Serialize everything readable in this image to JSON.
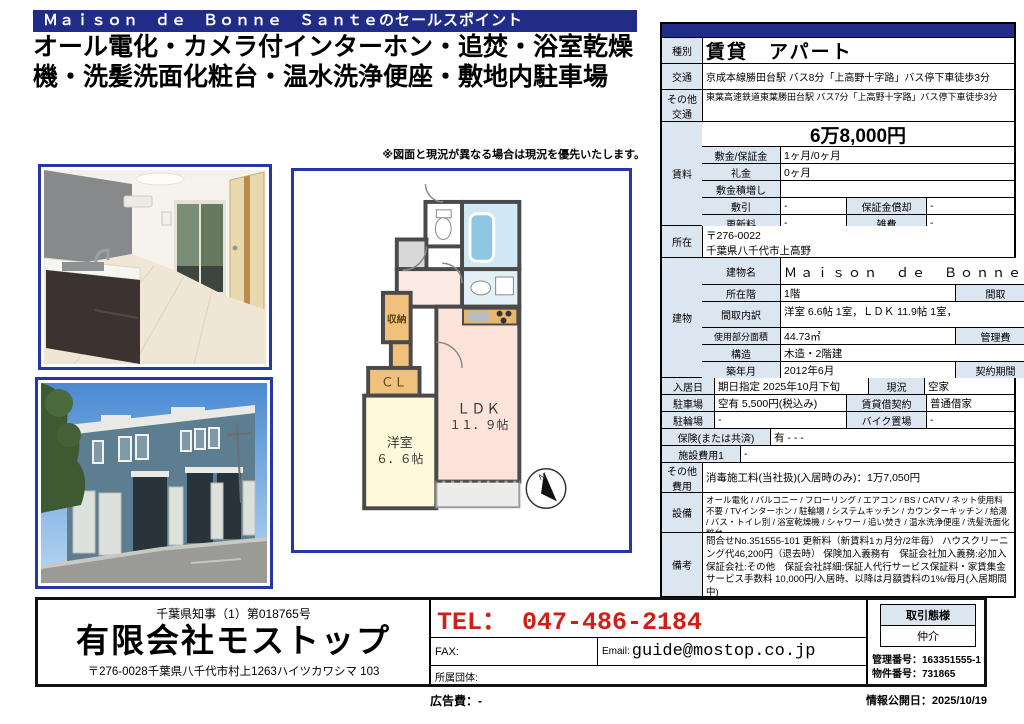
{
  "header": {
    "title_bar": "Ｍａｉｓｏｎ　ｄｅ　Ｂｏｎｎｅ　Ｓａｎｔｅのセールスポイント",
    "sales_points": "オール電化・カメラ付インターホン・追焚・浴室乾燥機・洗髪洗面化粧台・温水洗浄便座・敷地内駐車場"
  },
  "note": "※図面と現況が異なる場合は現況を優先いたします。",
  "floorplan": {
    "closet": "収納",
    "cl": "ＣＬ",
    "ldk_name": "ＬＤＫ",
    "ldk_size": "１１．９帖",
    "room_name": "洋室",
    "room_size": "６．６帖",
    "compass_n": "N"
  },
  "table": {
    "type": {
      "label": "種別",
      "value": "賃貸　アパート"
    },
    "access": {
      "label": "交通",
      "value": "京成本線勝田台駅 バス8分「上高野十字路」バス停下車徒歩3分"
    },
    "other_access": {
      "label": "その他 交通",
      "value": "東葉高速鉄道東葉勝田台駅 バス7分「上高野十字路」バス停下車徒歩3分"
    },
    "rent": {
      "label": "賃料",
      "price": "6万8,000円",
      "deposit": {
        "label": "敷金/保証金",
        "value": "1ヶ月/0ヶ月"
      },
      "key_money": {
        "label": "礼金",
        "value": "0ヶ月"
      },
      "deposit_increase": {
        "label": "敷金積増し",
        "value": ""
      },
      "shikibiki": {
        "label": "敷引",
        "value": "-"
      },
      "guarantee_amort": {
        "label": "保証金償却",
        "value": "-"
      },
      "renewal_fee": {
        "label": "更新料",
        "value": "-"
      },
      "misc_fee": {
        "label": "雑費",
        "value": "-"
      }
    },
    "location": {
      "label": "所在",
      "postal": "〒276-0022",
      "address": "千葉県八千代市上高野"
    },
    "building": {
      "label": "建物",
      "name": {
        "label": "建物名",
        "value": "Ｍａｉｓｏｎ　ｄｅ　Ｂｏｎｎｅ　Ｓａｎｔｅ"
      },
      "floor": {
        "label": "所在階",
        "value": "1階"
      },
      "madori": {
        "label": "間取",
        "value": "１ＬＤＫ"
      },
      "madori_detail": {
        "label": "間取内訳",
        "value": "洋室 6.6帖 1室，ＬＤＫ 11.9帖 1室，"
      },
      "area": {
        "label": "使用部分面積",
        "value": "44.73㎡"
      },
      "mgmt_fee": {
        "label": "管理費",
        "value": "3,000円"
      },
      "structure": {
        "label": "構造",
        "value": "木造・2階建"
      },
      "built": {
        "label": "築年月",
        "value": "2012年6月"
      },
      "contract_term": {
        "label": "契約期間",
        "value": "2年"
      }
    },
    "move_in": {
      "label": "入居日",
      "value": "期日指定 2025年10月下旬"
    },
    "current": {
      "label": "現況",
      "value": "空家"
    },
    "parking": {
      "label": "駐車場",
      "value": "空有 5,500円(税込み)"
    },
    "lease_type": {
      "label": "賃貸借契約",
      "value": "普通借家"
    },
    "bicycle": {
      "label": "駐輪場",
      "value": "-"
    },
    "bike": {
      "label": "バイク置場",
      "value": "-"
    },
    "insurance": {
      "label": "保険(または共済)",
      "value": "有 - - -"
    },
    "facility_cost": {
      "label": "施設費用1",
      "value": "-"
    },
    "other_cost": {
      "label": "その他 費用",
      "value": "消毒施工料(当社扱)(入居時のみ)：1万7,050円"
    },
    "equipment": {
      "label": "設備",
      "value": "オール電化 / バルコニー / フローリング / エアコン / BS / CATV / ネット使用料不要 / TVインターホン / 駐輪場 / システムキッチン / カウンターキッチン / 給湯 / バス・トイレ別 / 浴室乾燥機 / シャワー / 追い焚き / 温水洗浄便座 / 洗髪洗面化粧台"
    },
    "remarks": {
      "label": "備考",
      "value": "問合せNo.351555-101 更新料（新賃料1ヵ月分/2年毎） ハウスクリーニング代46,200円（退去時） 保険加入義務有　保証会社加入義務:必加入　保証会社:その他　保証会社詳細:保証人代行サービス保証料・家賃集金サービス手数料 10,000円/入居時、以降は月額賃料の1%/毎月(入居期間中)"
    }
  },
  "footer": {
    "license": "千葉県知事（1）第018765号",
    "company": "有限会社モストップ",
    "address": "〒276-0028千葉県八千代市村上1263ハイツカワシマ 103",
    "tel": "TEL： 047-486-2184",
    "fax_label": "FAX:",
    "email_label": "Email:",
    "email": "guide@mostop.co.jp",
    "org_label": "所属団体:",
    "deal_type_header": "取引態様",
    "deal_type": "仲介",
    "mgmt_no": "管理番号：163351555-1",
    "property_no": "物件番号：731865",
    "ad_fee": "広告費：-",
    "published": "情報公開日：2025/10/19"
  },
  "colors": {
    "accent_navy": "#202c87",
    "label_bg": "#dce6f1",
    "tel_red": "#d21e18",
    "frame_blue": "#2436a8"
  }
}
